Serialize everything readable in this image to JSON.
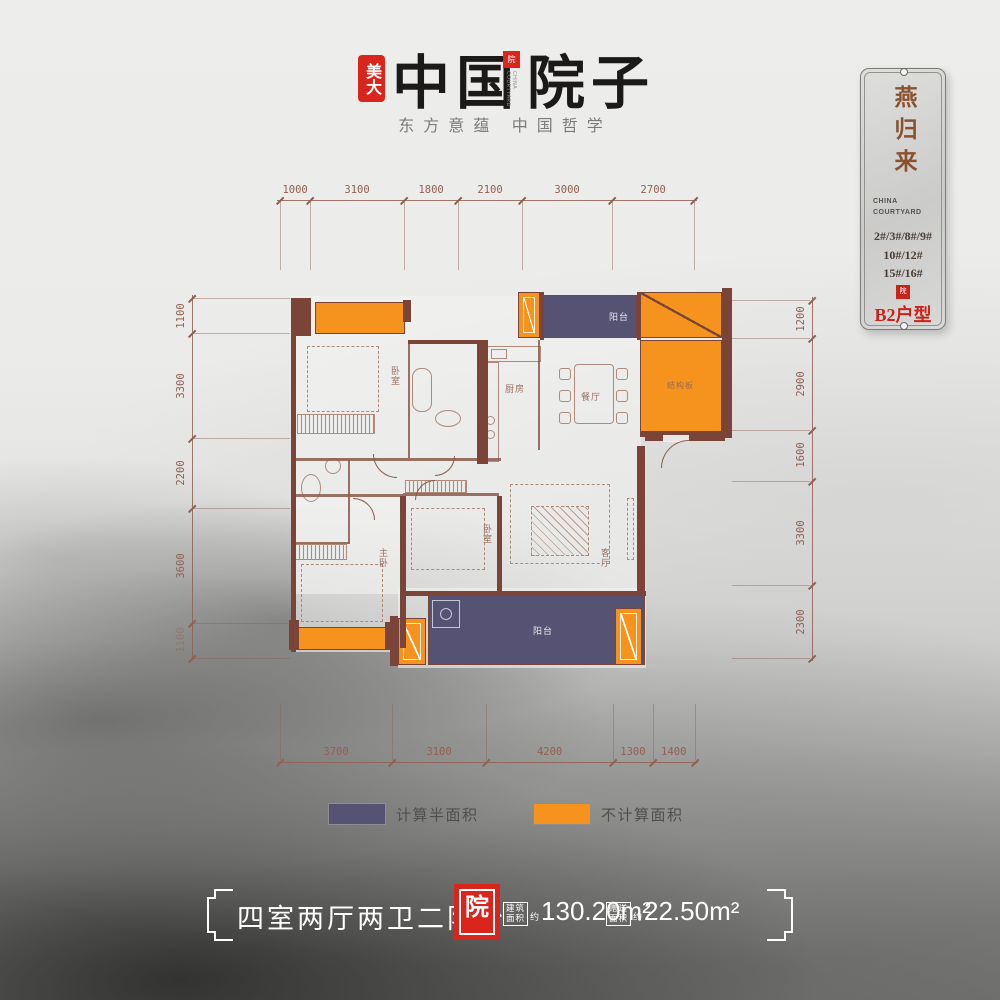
{
  "header": {
    "brand_seal": "美大",
    "title_left": "中国",
    "title_right": "院子",
    "mini_seal_glyph": "院",
    "mini_seal_caption": "CHINA COURTYARD",
    "subtitle": "东方意蕴  中国哲学"
  },
  "plaque": {
    "name": "燕归来",
    "caption": [
      "CHINA",
      "COURTYARD"
    ],
    "buildings": [
      "2#/3#/8#/9#",
      "10#/12#",
      "15#/16#"
    ],
    "seal_glyph": "院",
    "unit_label": "B2户型"
  },
  "floorplan": {
    "room_labels": {
      "bedroom_top": "卧室",
      "kitchen": "厨房",
      "dining": "餐厅",
      "balcony_top": "阳台",
      "structure_slab": "结构板",
      "master_bedroom": "主卧",
      "bedroom_mid": "卧室",
      "living": "客厅",
      "balcony_bottom": "阳台"
    },
    "dimensions_mm": {
      "top": [
        1000,
        3100,
        1800,
        2100,
        3000,
        2700
      ],
      "bottom": [
        3700,
        3100,
        4200,
        1300,
        1400
      ],
      "left": [
        1100,
        3300,
        2200,
        3600,
        1100
      ],
      "right": [
        1200,
        2900,
        1600,
        3300,
        2300
      ]
    }
  },
  "legend": {
    "items": [
      {
        "color": "#565273",
        "label": "计算半面积"
      },
      {
        "color": "#F6921E",
        "label": "不计算面积"
      }
    ]
  },
  "footer": {
    "layout_title": "四室两厅两卫二阳台",
    "seal_glyph": "院",
    "metrics": [
      {
        "box": [
          "建筑",
          "面积"
        ],
        "approx": "约",
        "value": "130.20m²"
      },
      {
        "box": [
          "赠送",
          "面积"
        ],
        "approx": "约",
        "value": "22.50m²"
      }
    ]
  },
  "colors": {
    "orange_not_counted": "#F6921E",
    "blue_half_area": "#565273",
    "wall_brown": "#7A4538",
    "dimension_brown": "#8F6152",
    "seal_red": "#D9251C",
    "accent_red": "#C9241A",
    "plaque_name_brown": "#8A512F"
  }
}
